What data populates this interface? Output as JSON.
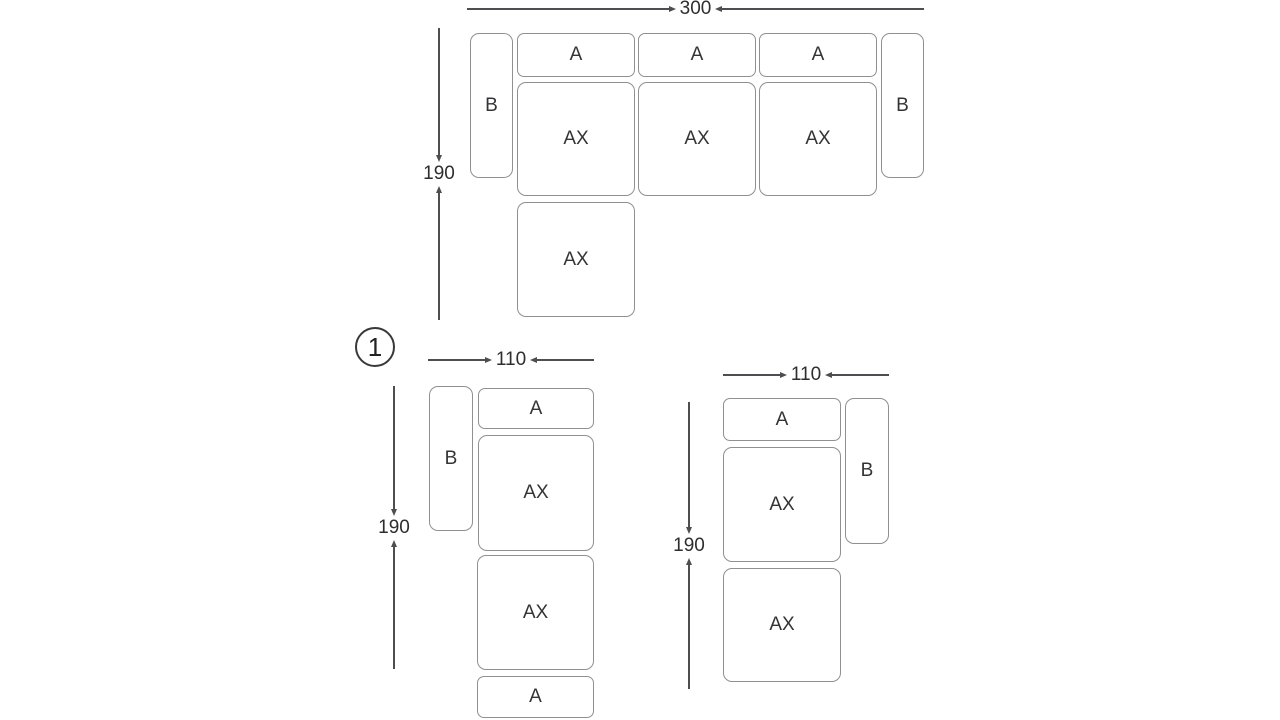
{
  "colors": {
    "background": "#ffffff",
    "box_border": "#8f9092",
    "dimension_line": "#4e4e50",
    "label_text": "#343436"
  },
  "top_diagram": {
    "width_label": "300",
    "height_label": "190",
    "left_arm_label": "B",
    "right_arm_label": "B",
    "back_labels": [
      "A",
      "A",
      "A"
    ],
    "seat_labels": [
      "AX",
      "AX",
      "AX"
    ],
    "chaise_label": "AX"
  },
  "bottom_left_diagram": {
    "figure_number": "1",
    "width_label": "110",
    "height_label": "190",
    "arm_label": "B",
    "top_back_label": "A",
    "seat_labels": [
      "AX",
      "AX"
    ],
    "bottom_back_label": "A"
  },
  "bottom_right_diagram": {
    "width_label": "110",
    "height_label": "190",
    "back_label": "A",
    "arm_label": "B",
    "seat_labels": [
      "AX",
      "AX"
    ]
  }
}
